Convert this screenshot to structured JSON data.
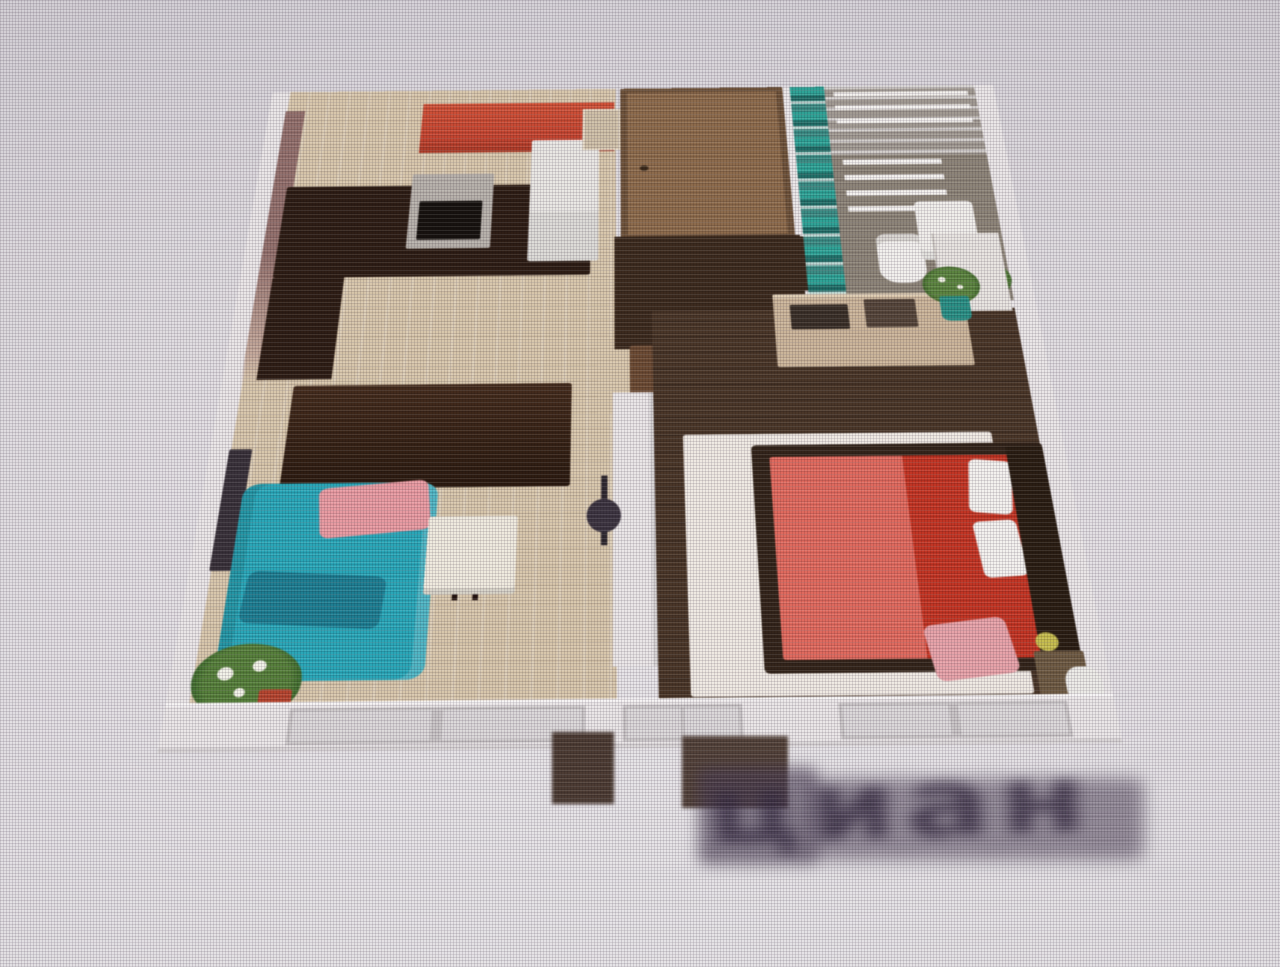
{
  "meta": {
    "type": "photo-of-screen",
    "content": "3D isometric floor plan render of a one-room apartment (real-estate listing image)"
  },
  "watermark": {
    "text": "циан"
  },
  "palette": {
    "background": "#dedade",
    "floor_main": "#d8c7ac",
    "floor_dark": "#42301f",
    "wall_white": "#eae6e7",
    "wall_red": "#c44531",
    "wall_mauve": "#93706c",
    "wall_teal": "#2fa396",
    "sofa_teal": "#2aa7b8",
    "bed_red": "#c23524",
    "stool_red": "#cf3a20",
    "counter_brown": "#2e1d15",
    "door_brown": "#8d6b4c"
  },
  "apartment": {
    "rooms": [
      {
        "name": "kitchen-living-room",
        "position": "left",
        "furniture": [
          "beige-curtains",
          "red-backsplash",
          "dark-kitchen-counter",
          "stove",
          "fridge",
          "bar-counter",
          "two-red-bar-stools",
          "wall-tv",
          "teal-sofa",
          "pink-sofa-pillow",
          "white-coffee-table",
          "flowering-plant"
        ]
      },
      {
        "name": "entrance-hall",
        "position": "top-center",
        "furniture": [
          "brown-entrance-door",
          "wall-shelf",
          "dark-brown-floor",
          "brown-rug"
        ]
      },
      {
        "name": "bathroom",
        "position": "top-right",
        "furniture": [
          "teal-striped-tile-wall",
          "wall-shelves",
          "towel-ladder",
          "toilet",
          "washing-machine",
          "potted-plant"
        ]
      },
      {
        "name": "bedroom",
        "position": "right",
        "furniture": [
          "wood-dresser",
          "white-wardrobe",
          "potted-plant",
          "white-rug",
          "double-bed-red-bedding",
          "white-pillows",
          "dark-headboard",
          "pink-pillow",
          "nightstand",
          "yellow-lamp",
          "white-vase"
        ]
      }
    ]
  }
}
